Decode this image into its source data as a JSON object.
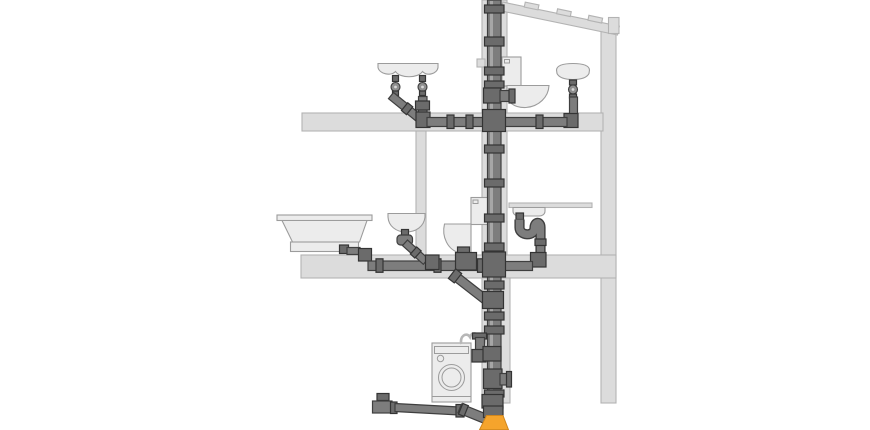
{
  "meta": {
    "description": "Cutaway diagram of a two-storey house drainage installation: a central vertical soil stack collecting waste branches from bathroom and kitchen fixtures on each floor down to the basement outlet",
    "text_labels": []
  },
  "colors": {
    "background": "#ffffff",
    "structure": "#dcdcdc",
    "structure_outline": "#b3b3b3",
    "fixture": "#ececec",
    "fixture_outline": "#9c9c9c",
    "pipe": "#7d7d7d",
    "pipe_highlight": "#a6a6a6",
    "pipe_outline": "#3f3f3f",
    "fitting": "#6b6b6b",
    "fitting_outline": "#343434",
    "hose": "#b7b7b7",
    "accent_orange": "#f5a42c",
    "orange_outline": "#d0861d"
  },
  "scene": {
    "building": [
      "roof-beam",
      "outer-wall",
      "pipe-shaft-wall",
      "floor-slab-upper",
      "floor-slab-lower",
      "interior-wall",
      "door-jamb-wall",
      "kitchen-counter",
      "flush-plate"
    ],
    "fixtures": [
      "double-washbasin",
      "wall-toilet-upper",
      "pedestal-basin",
      "bathtub",
      "washbasin",
      "toilet",
      "kitchen-sink",
      "washing-machine"
    ],
    "piping": [
      "soil-stack",
      "upper-floor-branch-left",
      "upper-floor-branch-right",
      "toilet-branch-upper",
      "lower-floor-collector",
      "kitchen-sink-trap",
      "toilet-drop-wye",
      "washing-machine-standpipe",
      "cleanout-access",
      "basement-branch",
      "stack-base-connector"
    ]
  }
}
